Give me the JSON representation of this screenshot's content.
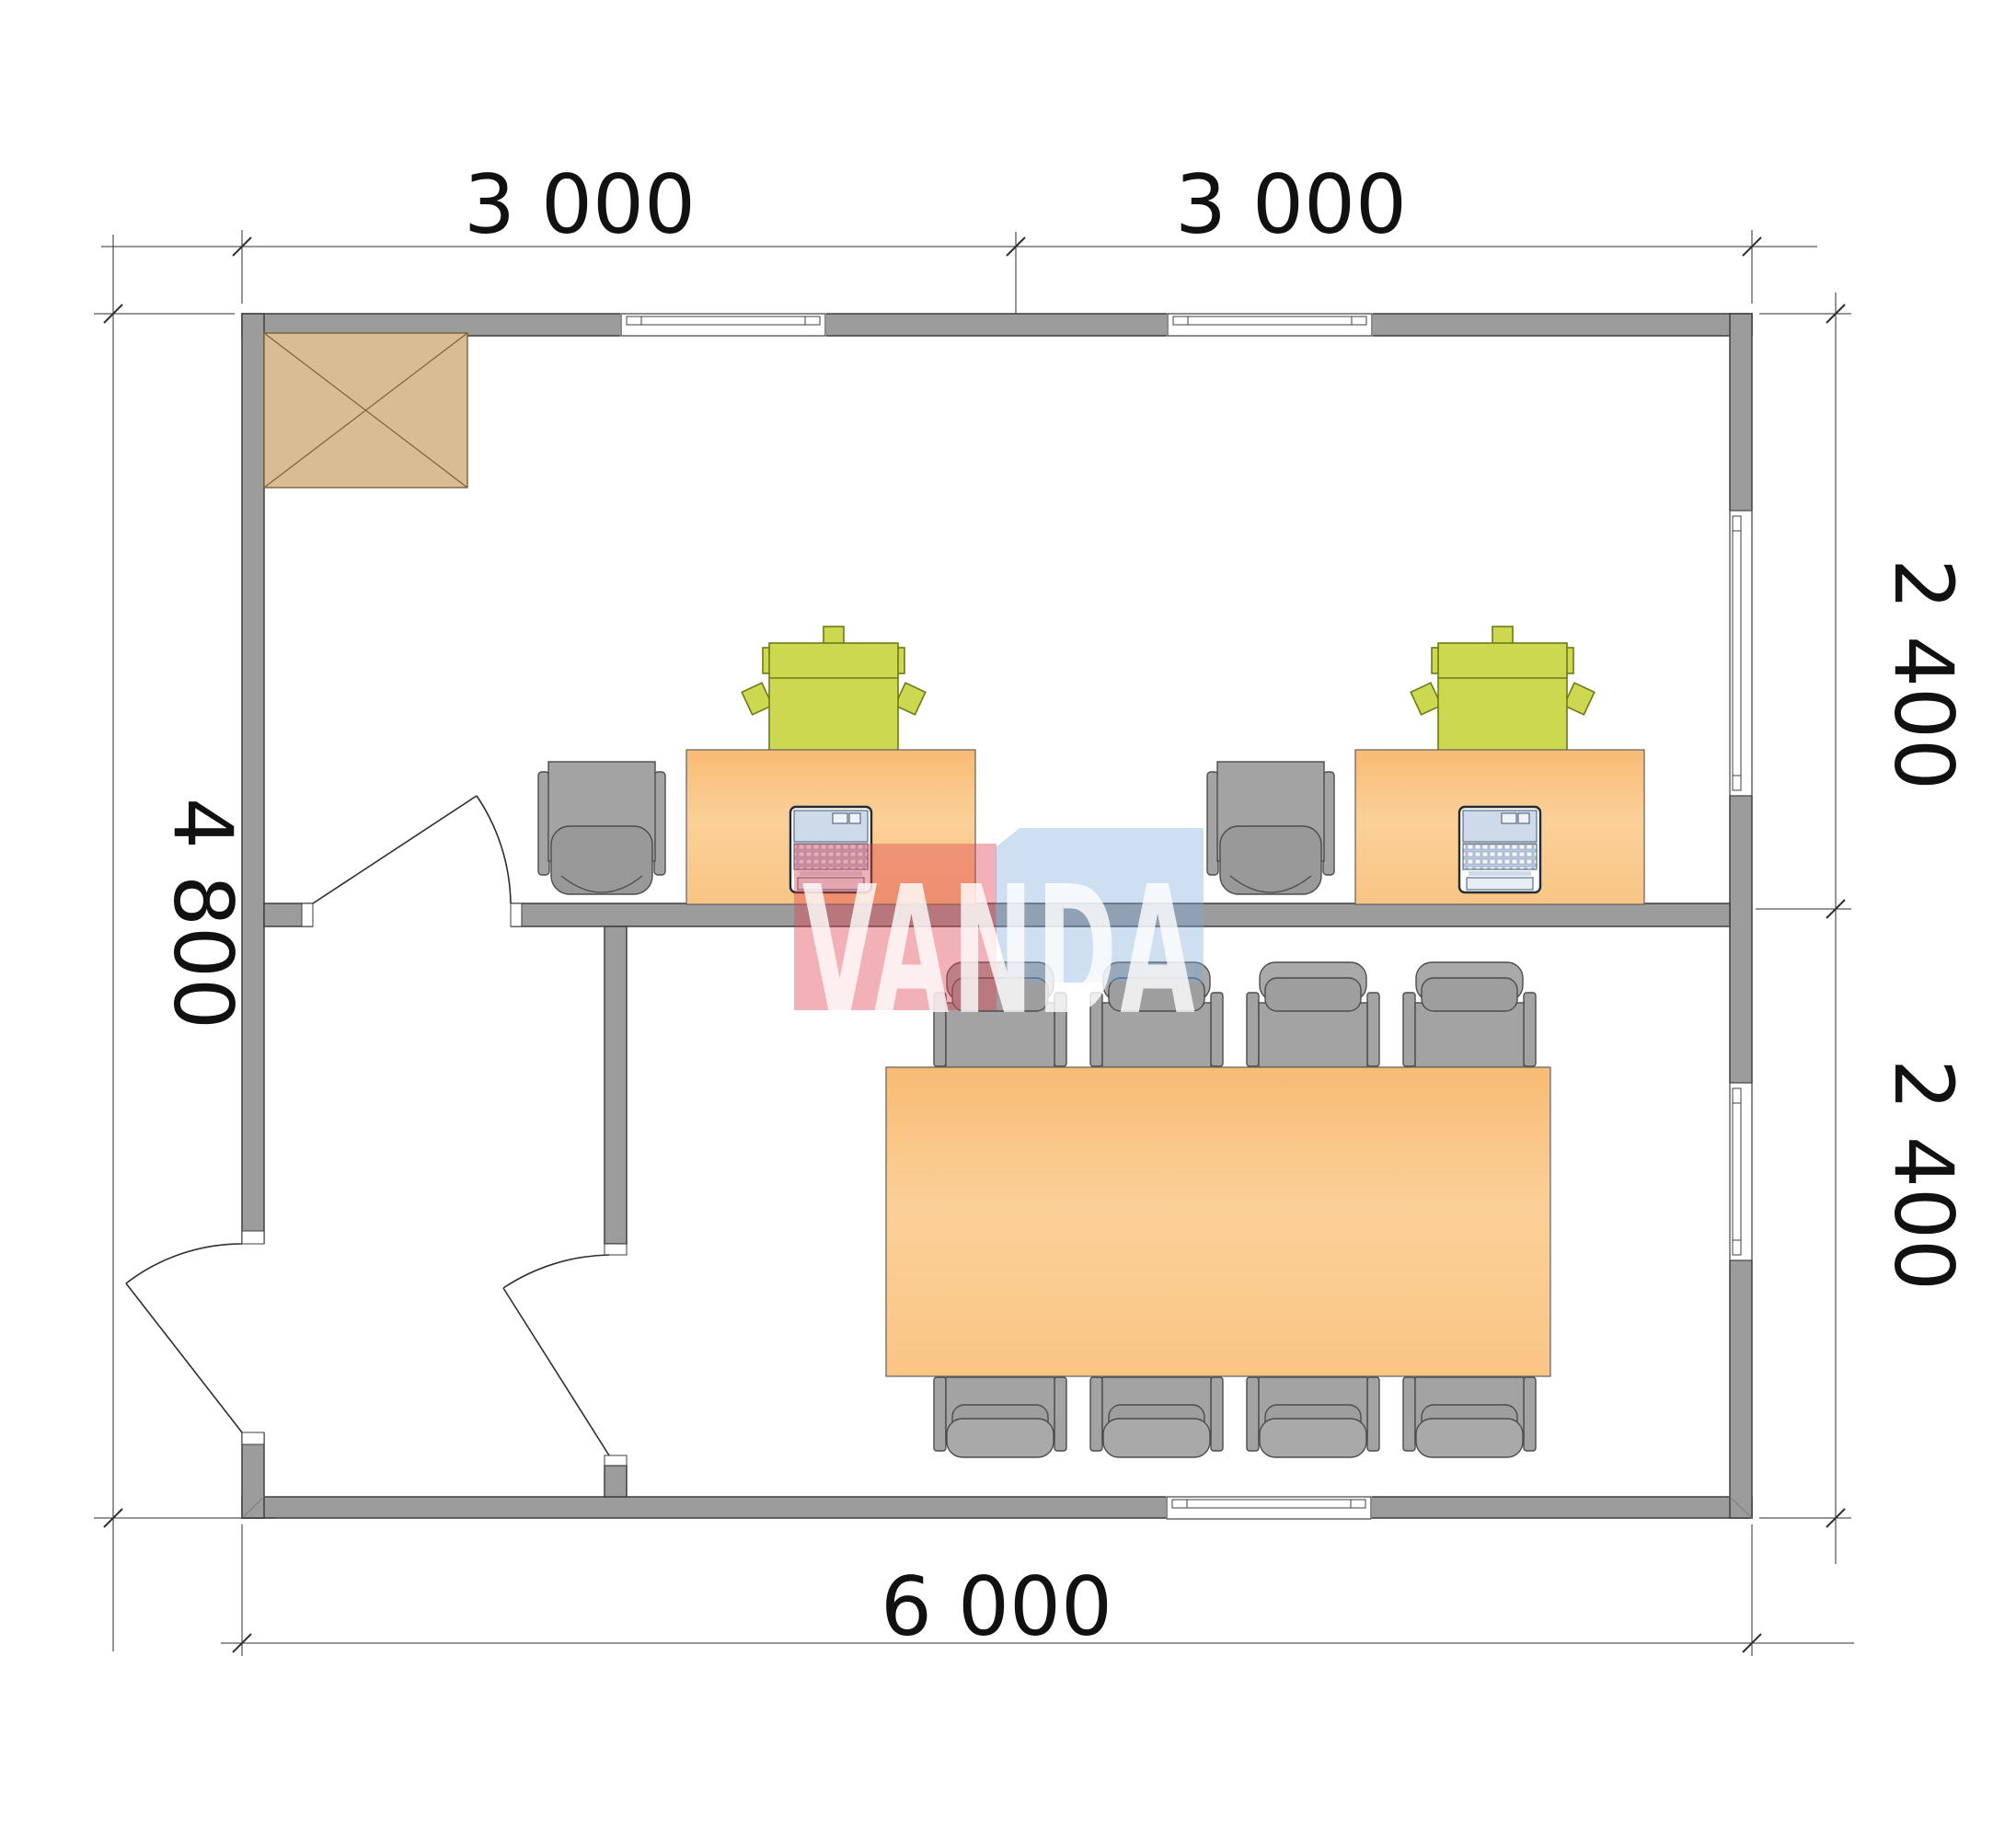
{
  "watermark": {
    "text": "VANDA"
  },
  "dimensions": {
    "top": [
      {
        "label": "3 000"
      },
      {
        "label": "3 000"
      }
    ],
    "right": [
      {
        "label": "2 400"
      },
      {
        "label": "2 400"
      }
    ],
    "left": {
      "label": "4 800"
    },
    "bottom": {
      "label": "6 000"
    }
  },
  "plan": {
    "overall_width_mm": 6000,
    "overall_depth_mm": 4800,
    "desks": 2,
    "desk_chairs": 2,
    "side_chairs": 2,
    "laptops": 2,
    "meeting_tables": 1,
    "meeting_chairs": 8,
    "doors": 3,
    "windows": 5,
    "shaft_symbols": 1
  },
  "colors": {
    "wall": "#9c9c9c",
    "wall-line": "#3f3f3f",
    "shaft": "#d9bc94",
    "shaft-line": "#7a6136",
    "desk-top": "#f8bf7b",
    "desk-light": "#fcd7a4",
    "chair-green": "#ccd84f",
    "chair-green-line": "#6d7a15",
    "chair-gray": "#a3a3a3",
    "chair-gray-dark": "#999999",
    "furn-line": "#4c4c4c",
    "laptop-screen": "#ccdaea",
    "laptop-keys": "#b9c8dc",
    "dim-line": "#2e2e2e",
    "dim-text": "#111111",
    "wm-red": "rgba(224,70,82,0.42)",
    "wm-blue": "rgba(125,172,217,0.38)",
    "wm-text": "rgba(255,255,255,0.80)"
  }
}
